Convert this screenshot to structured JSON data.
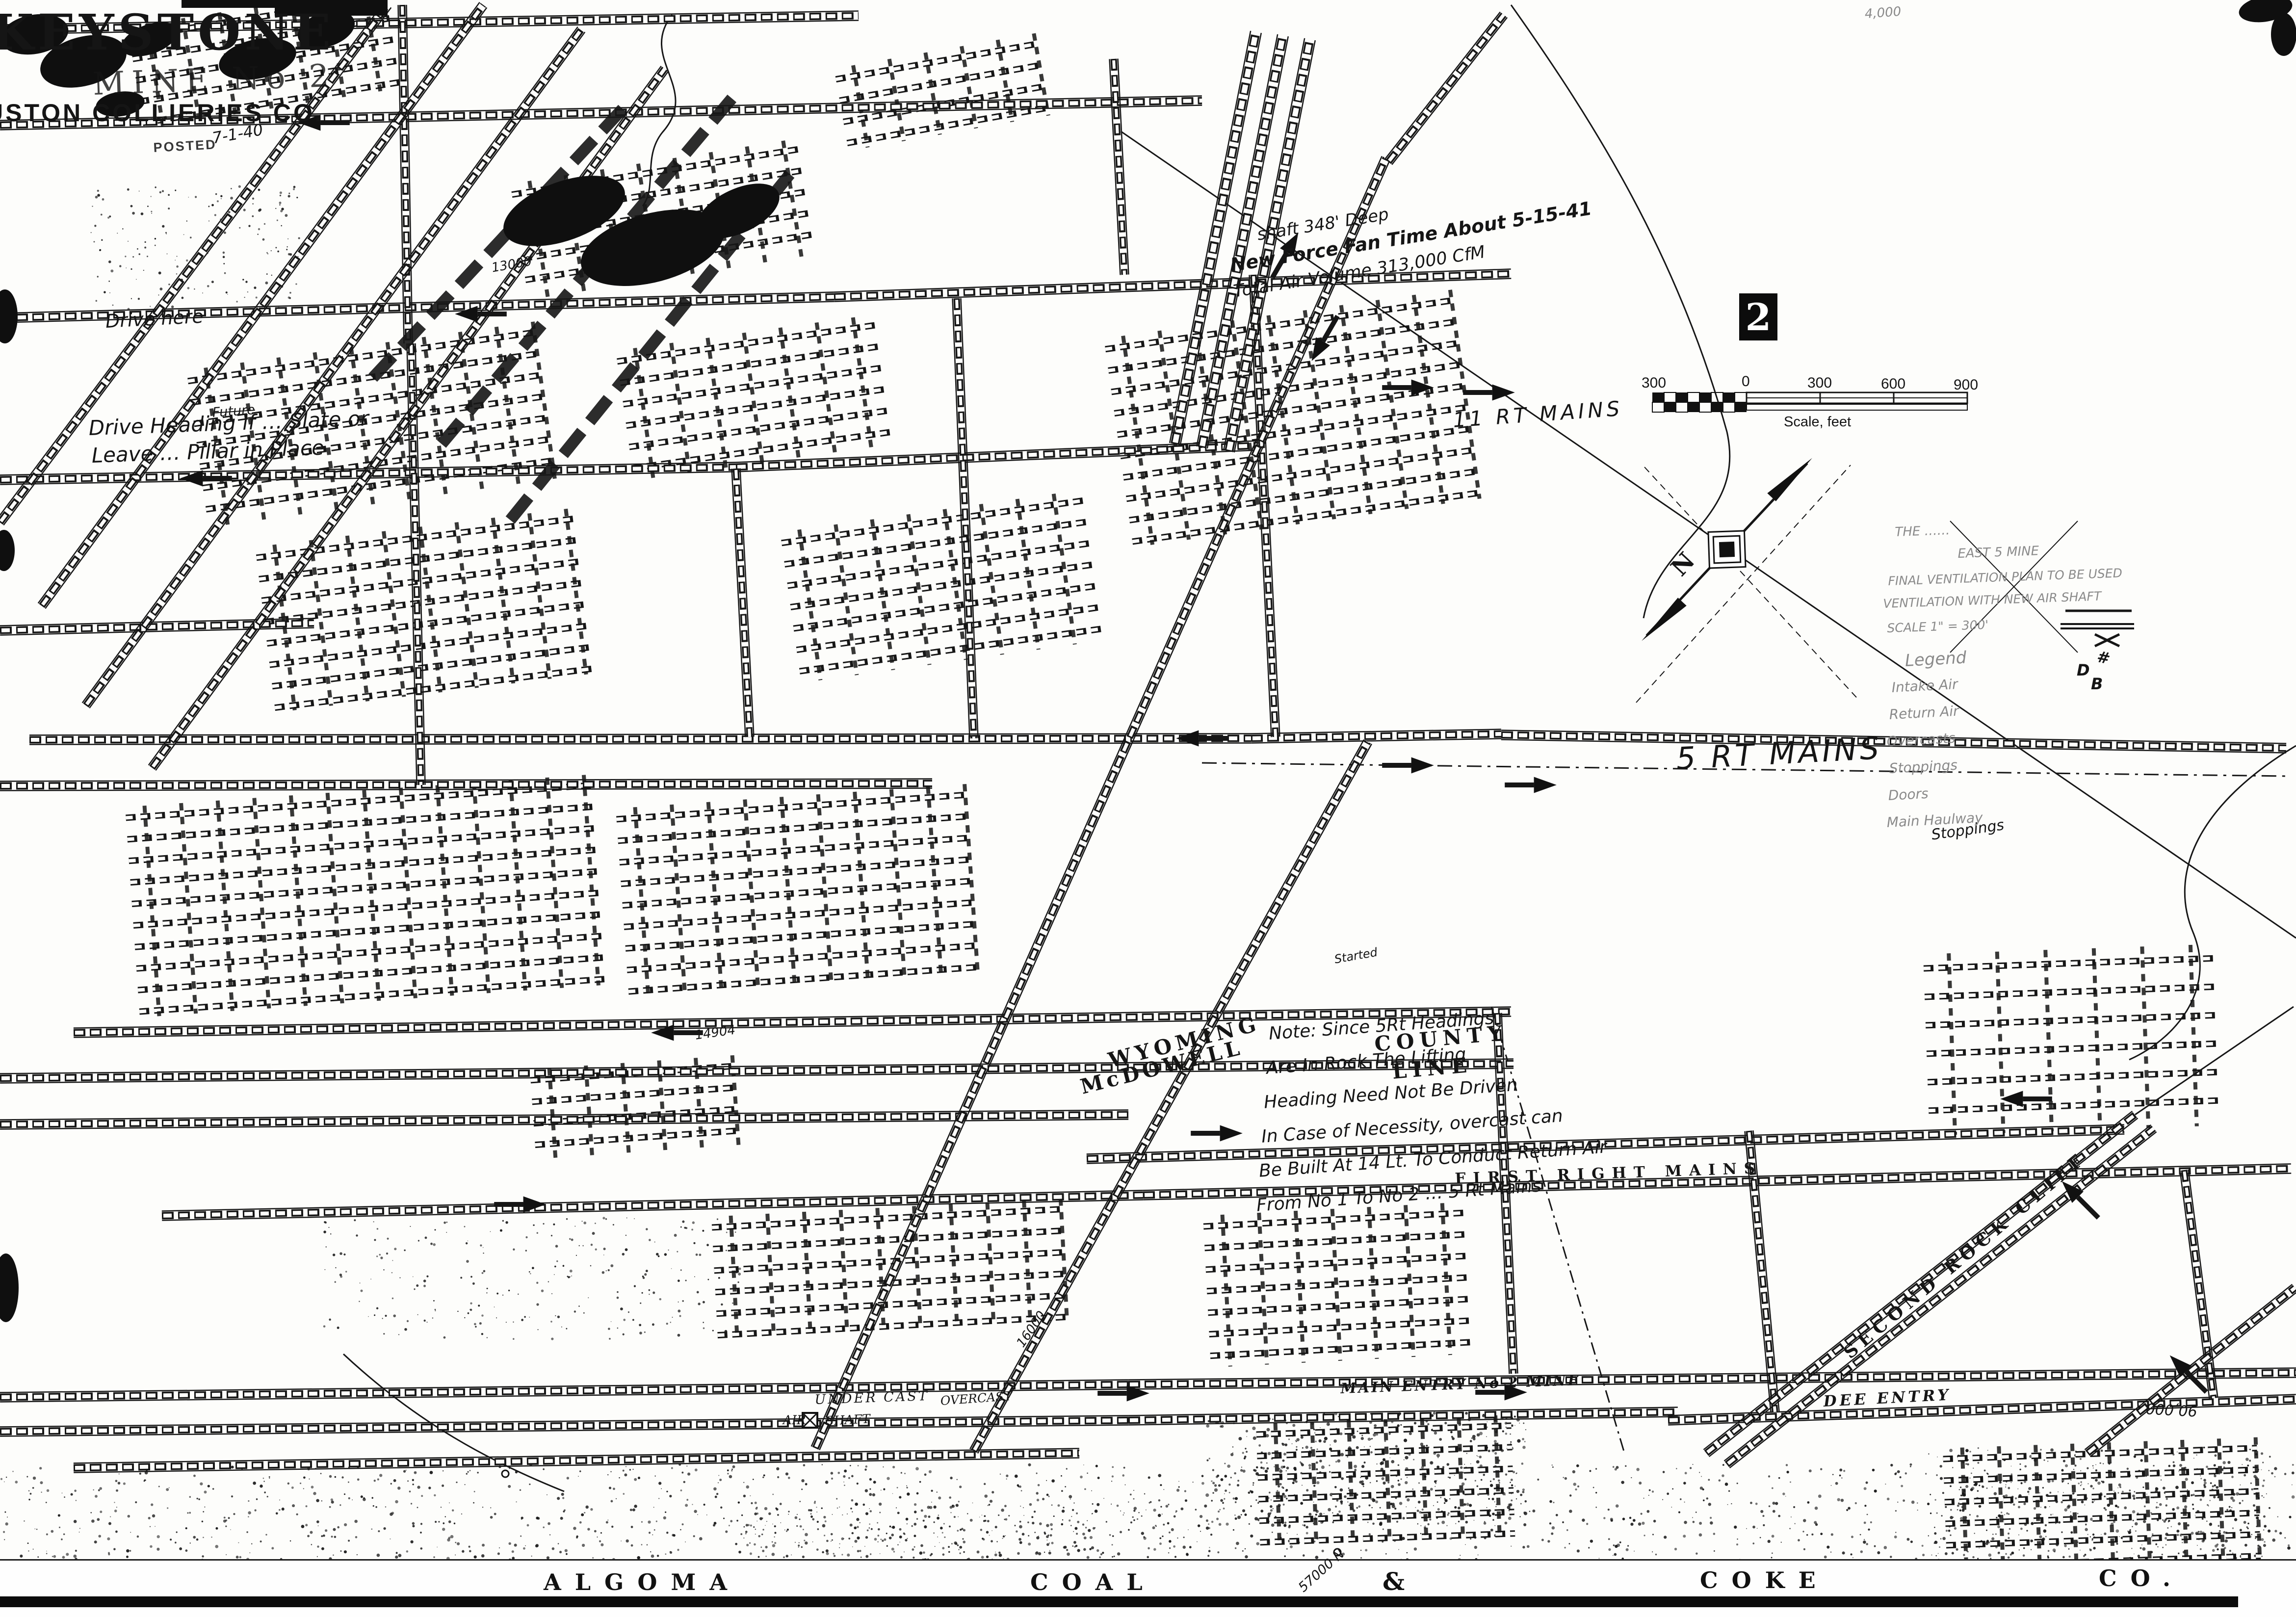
{
  "title_block": {
    "mine_name": "KEYSTONE",
    "mine_no": "MINE No 2",
    "company": "USTON COLLIERIES CO.",
    "posted_stamp": "POSTED",
    "posted_date": "7-1-40"
  },
  "marker": {
    "sheet_number": "2"
  },
  "scale_bar": {
    "ticks": [
      "300",
      "0",
      "300",
      "600",
      "900"
    ],
    "caption": "Scale, feet"
  },
  "compass": {
    "north_label": "N"
  },
  "banner": {
    "words": [
      "ALGOMA",
      "COAL",
      "&",
      "COKE",
      "CO."
    ]
  },
  "labels": {
    "rt11": "11 RT MAINS",
    "rt5": "5 RT MAINS",
    "first_right": "FIRST RIGHT MAINS",
    "main_entry": "MAIN ENTRY No 2 MINE",
    "dee_entry": "DEE ENTRY",
    "undercast": "UNDER CAST",
    "air": "AIR",
    "shaft": "SHAFT",
    "overcast": "OVERCAST",
    "wyoming": "WYOMING",
    "mcdowell": "McDOWELL",
    "county": "COUNTY",
    "line": "LINE",
    "second_rock_cliff": "SECOND ROCK CLIFF",
    "stoppings": "Stoppings"
  },
  "numbers": {
    "n13000": "13000",
    "n14904": "14904",
    "n16000": "16000",
    "n90000": "90,000",
    "n57000": "57000 N",
    "n4000": "4,000"
  },
  "annotations": {
    "fan_note": [
      "shaft 348' Deep",
      "New Force Fan Time About 5-15-41",
      "Total Air Volume 313,000 CfM"
    ],
    "note_5rt": [
      "Note: Since 5Rt Headings",
      "Are In Rock The Lifting",
      "Heading Need Not Be Driven",
      "In Case of Necessity, overcast can",
      "Be Built At 14 Lt. To Conduct Return Air",
      "From No 1 To No 2 … 5 Rt Mains"
    ],
    "drive_note_top": "Drive here",
    "drive_note": [
      "Drive Heading if … Slate or",
      "Leave … Pillar in Place"
    ],
    "future_note": "Future",
    "started_note": "Started",
    "plan_note": [
      "THE ……",
      "EAST 5 MINE",
      "FINAL VENTILATION PLAN TO BE USED",
      "VENTILATION WITH NEW AIR SHAFT",
      "SCALE 1\" = 300'"
    ],
    "legend": {
      "title": "Legend",
      "items": [
        "Intake Air",
        "Return Air",
        "Overcasts",
        "Stoppings",
        "Doors",
        "Main Haulway"
      ]
    },
    "symbol_marks": {
      "hash": "#",
      "d": "D",
      "b": "B"
    }
  }
}
